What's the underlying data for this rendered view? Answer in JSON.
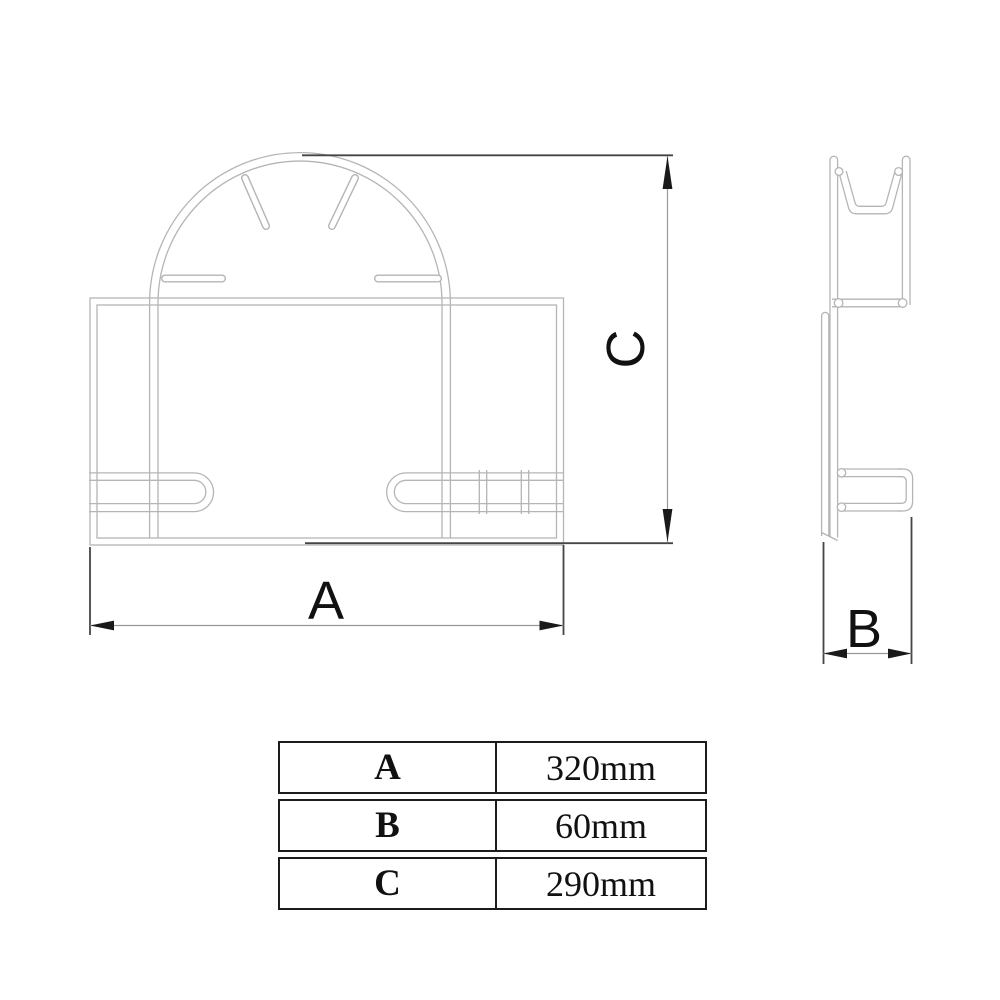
{
  "drawing": {
    "dimension_labels": {
      "a": "A",
      "b": "B",
      "c": "C"
    },
    "colors": {
      "background": "#ffffff",
      "object_line": "#b5b5b5",
      "extension_line": "#454545",
      "dimension_line": "#999999",
      "arrow": "#1a1a1a",
      "text": "#111111",
      "table_border": "#1c1c1c"
    }
  },
  "table": {
    "rows": [
      {
        "label": "A",
        "value": "320mm"
      },
      {
        "label": "B",
        "value": "60mm"
      },
      {
        "label": "C",
        "value": "290mm"
      }
    ]
  }
}
